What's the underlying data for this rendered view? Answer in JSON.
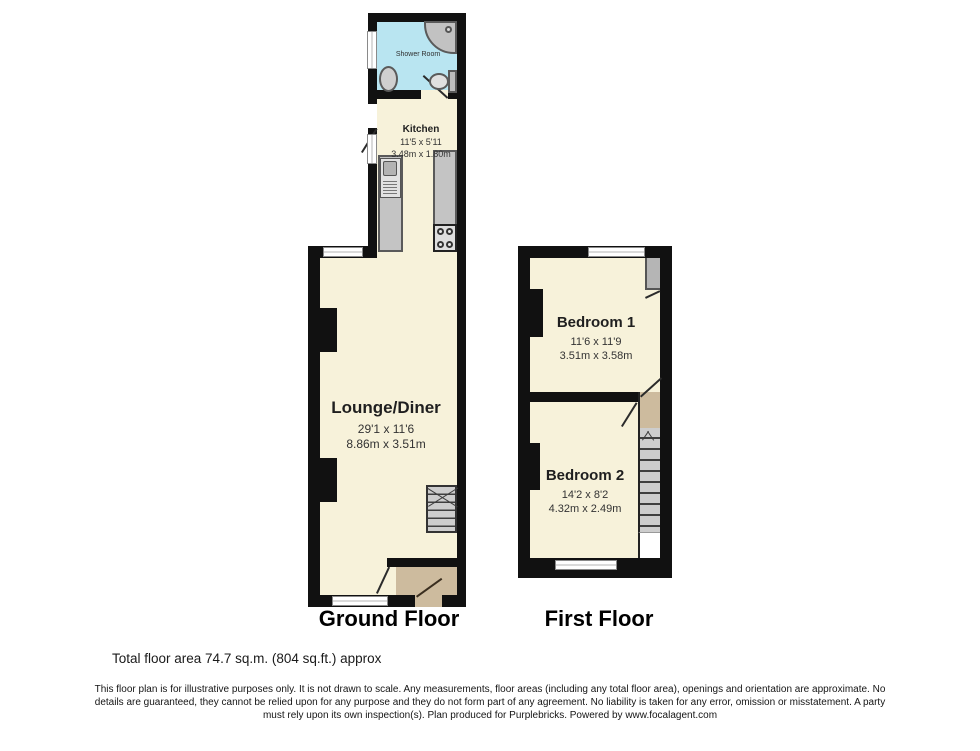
{
  "colors": {
    "wall": "#111111",
    "room": "#f7f2da",
    "wet": "#b9e5f1",
    "hall": "#cdbb9e",
    "gray": "#c4c4c4"
  },
  "ground_floor": {
    "label": "Ground Floor",
    "shower_room": {
      "name": "Shower Room"
    },
    "kitchen": {
      "name": "Kitchen",
      "imperial": "11'5 x 5'11",
      "metric": "3.48m x 1.80m"
    },
    "lounge": {
      "name": "Lounge/Diner",
      "imperial": "29'1 x 11'6",
      "metric": "8.86m x 3.51m"
    }
  },
  "first_floor": {
    "label": "First Floor",
    "bedroom1": {
      "name": "Bedroom 1",
      "imperial": "11'6 x 11'9",
      "metric": "3.51m x 3.58m"
    },
    "bedroom2": {
      "name": "Bedroom 2",
      "imperial": "14'2 x 8'2",
      "metric": "4.32m x 2.49m"
    }
  },
  "footer": {
    "total_area": "Total floor area 74.7 sq.m. (804 sq.ft.) approx",
    "disclaimer": "This floor plan is for illustrative purposes only. It is not drawn to scale. Any measurements, floor areas (including any total floor area), openings and orientation are approximate. No details are guaranteed, they cannot be relied upon for any purpose and they do not form part of any agreement. No liability is taken for any error, omission or misstatement. A party must rely upon its own inspection(s). Plan produced for Purplebricks. Powered by www.focalagent.com"
  }
}
